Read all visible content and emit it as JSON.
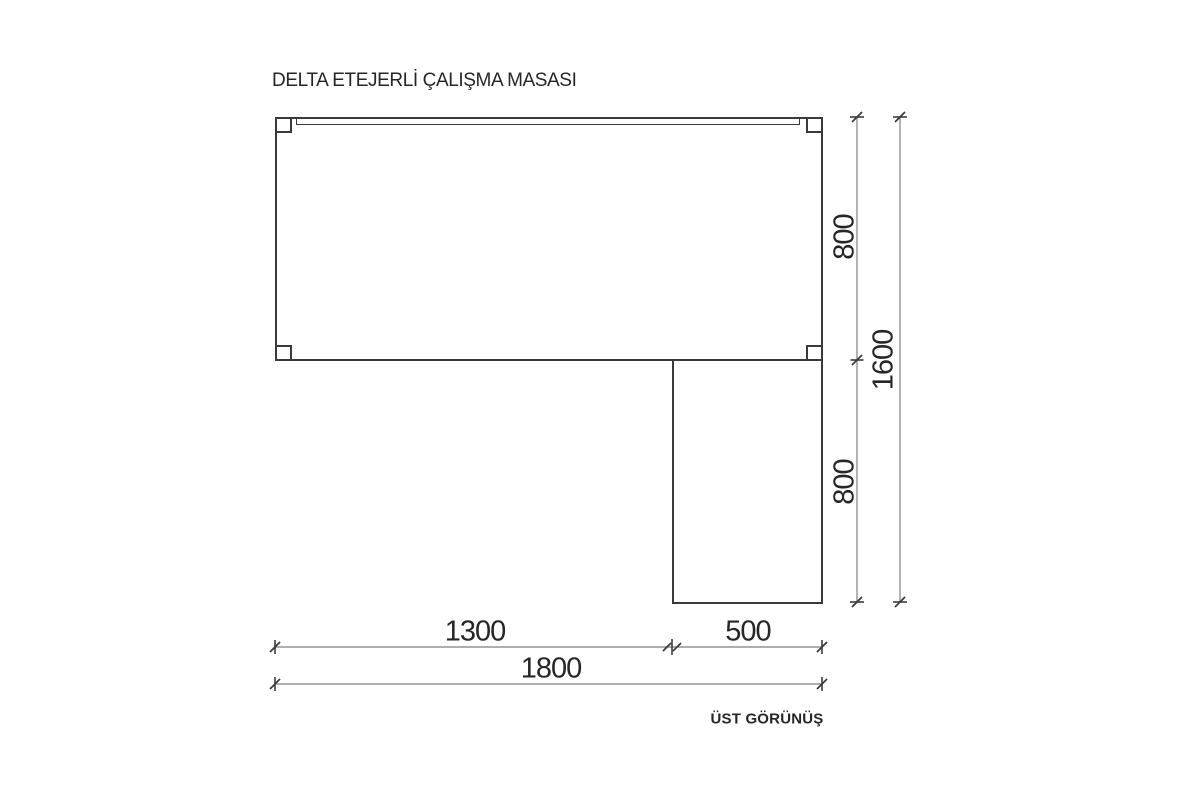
{
  "title": "DELTA ETEJERLİ ÇALIŞMA MASASI",
  "view_label": "ÜST GÖRÜNÜŞ",
  "dimension_labels": {
    "right_upper": "800",
    "right_lower": "800",
    "right_total": "1600",
    "bottom_main": "1300",
    "bottom_return": "500",
    "bottom_total": "1800"
  },
  "colors": {
    "outline": "#3a3a3a",
    "dim_line": "#7e7e7e",
    "tick": "#3c3c3c",
    "text": "#262626",
    "background": "#ffffff"
  }
}
